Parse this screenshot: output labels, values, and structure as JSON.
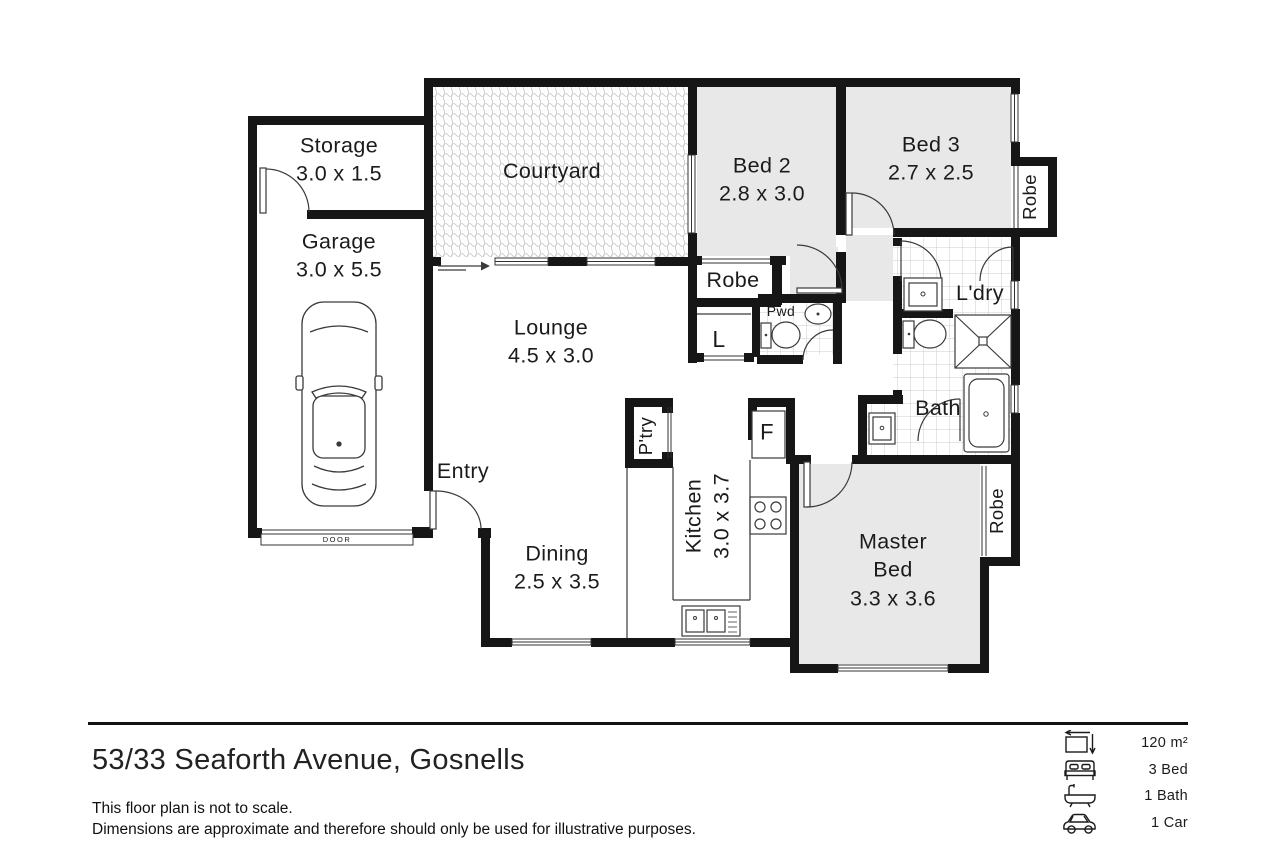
{
  "plan": {
    "rooms": {
      "storage": {
        "name": "Storage",
        "dims": "3.0 x 1.5"
      },
      "garage": {
        "name": "Garage",
        "dims": "3.0 x 5.5"
      },
      "courtyard": {
        "name": "Courtyard"
      },
      "bed2": {
        "name": "Bed 2",
        "dims": "2.8 x 3.0"
      },
      "bed3": {
        "name": "Bed 3",
        "dims": "2.7 x 2.5"
      },
      "robe_bed3": {
        "name": "Robe"
      },
      "robe_bed2": {
        "name": "Robe"
      },
      "linen": {
        "name": "L"
      },
      "powder": {
        "name": "Pwd"
      },
      "laundry": {
        "name": "L'dry"
      },
      "lounge": {
        "name": "Lounge",
        "dims": "4.5 x 3.0"
      },
      "bath": {
        "name": "Bath"
      },
      "pantry": {
        "name": "P'try"
      },
      "kitchen": {
        "name": "Kitchen",
        "dims": "3.0 x 3.7"
      },
      "fridge": {
        "name": "F"
      },
      "entry": {
        "name": "Entry"
      },
      "dining": {
        "name": "Dining",
        "dims": "2.5 x 3.5"
      },
      "master": {
        "line1": "Master",
        "line2": "Bed",
        "dims": "3.3 x 3.6"
      },
      "robe_master": {
        "name": "Robe"
      }
    },
    "garage_door_label": "DOOR"
  },
  "footer": {
    "address": "53/33 Seaforth Avenue, Gosnells",
    "disclaimer_line1": "This floor plan is not to scale.",
    "disclaimer_line2": "Dimensions are approximate and therefore should only be used for illustrative purposes.",
    "stats": [
      {
        "icon": "area-icon",
        "label": "120 m²"
      },
      {
        "icon": "bed-icon",
        "label": "3 Bed"
      },
      {
        "icon": "bath-icon",
        "label": "1 Bath"
      },
      {
        "icon": "car-icon",
        "label": "1 Car"
      }
    ]
  },
  "colors": {
    "wall": "#161616",
    "room_fill": "#e8e8e8",
    "tile_line": "#cccccc",
    "pattern": "#c4c4c4"
  }
}
